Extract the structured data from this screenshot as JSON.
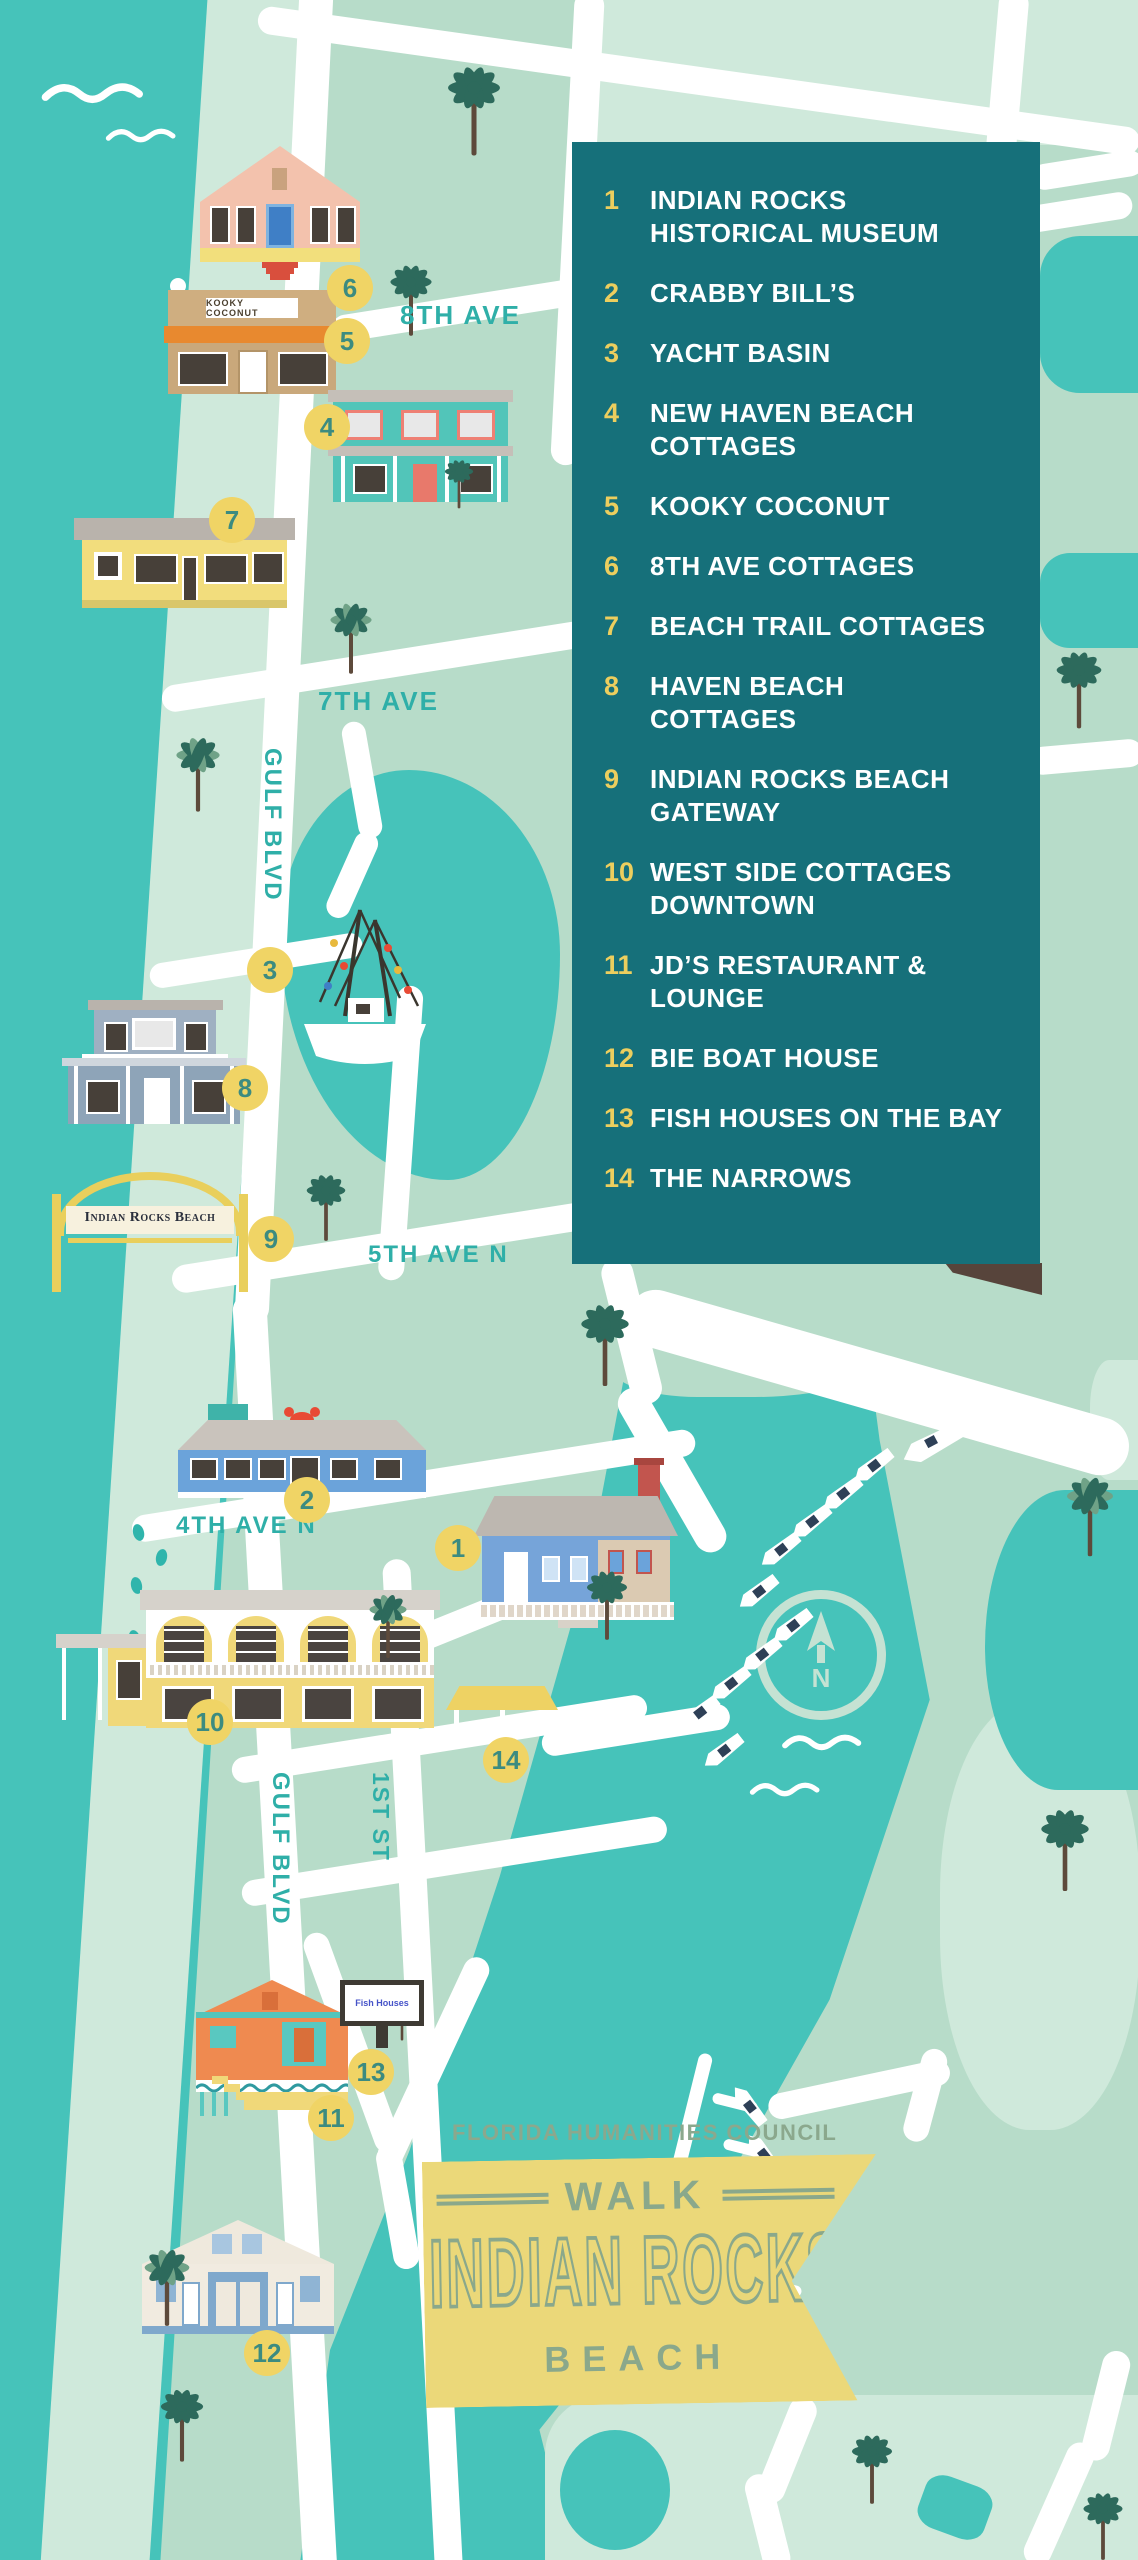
{
  "legend": {
    "items": [
      {
        "num": "1",
        "label": "INDIAN ROCKS\nHISTORICAL MUSEUM"
      },
      {
        "num": "2",
        "label": "CRABBY BILL’S"
      },
      {
        "num": "3",
        "label": "YACHT BASIN"
      },
      {
        "num": "4",
        "label": "NEW HAVEN BEACH\nCOTTAGES"
      },
      {
        "num": "5",
        "label": "KOOKY COCONUT"
      },
      {
        "num": "6",
        "label": "8TH AVE COTTAGES"
      },
      {
        "num": "7",
        "label": "BEACH TRAIL COTTAGES"
      },
      {
        "num": "8",
        "label": "HAVEN BEACH\nCOTTAGES"
      },
      {
        "num": "9",
        "label": "INDIAN ROCKS  BEACH\nGATEWAY"
      },
      {
        "num": "10",
        "label": "WEST SIDE COTTAGES\nDOWNTOWN"
      },
      {
        "num": "11",
        "label": "JD’S RESTAURANT &\nLOUNGE"
      },
      {
        "num": "12",
        "label": "BIE BOAT HOUSE"
      },
      {
        "num": "13",
        "label": "FISH HOUSES ON THE BAY"
      },
      {
        "num": "14",
        "label": "THE NARROWS"
      }
    ]
  },
  "markers": [
    "1",
    "2",
    "3",
    "4",
    "5",
    "6",
    "7",
    "8",
    "9",
    "10",
    "11",
    "12",
    "13",
    "14"
  ],
  "streets": {
    "ave8": "8TH AVE",
    "ave7": "7TH AVE",
    "gulf_upper": "GULF BLVD",
    "ave5": "5TH AVE N",
    "ave4": "4TH AVE N",
    "gulf_lower": "GULF BLVD",
    "st1": "1ST ST"
  },
  "signs": {
    "gateway": "Indian Rocks Beach",
    "kooky": "KOOKY COCONUT",
    "fish": "Fish Houses"
  },
  "compass": {
    "n": "N"
  },
  "footer": {
    "council": "FLORIDA HUMANITIES COUNCIL",
    "walk": "WALK",
    "title": "INDIAN ROCKS",
    "subtitle": "BEACH"
  },
  "colors": {
    "water_teal": "#46c3ba",
    "land_green": "#b7dcc9",
    "land_light": "#cfe9db",
    "road_white": "#ffffff",
    "legend_bg": "#16707a",
    "legend_number_yellow": "#ecce5e",
    "marker_yellow": "#f0d465",
    "street_label_teal": "#2fafa8",
    "banner_yellow": "#ebd879",
    "banner_text_green": "#8aa88b",
    "palm_green": "#2d6a5c"
  }
}
